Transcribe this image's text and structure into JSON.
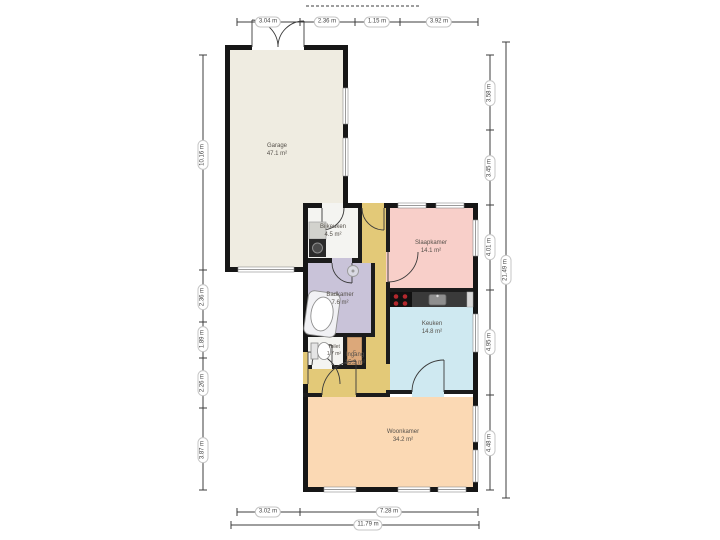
{
  "plan": {
    "rooms": [
      {
        "name": "Garage",
        "area": "47.1 m²"
      },
      {
        "name": "Bijkeuken",
        "area": "4.5 m²"
      },
      {
        "name": "Slaapkamer",
        "area": "14.1 m²"
      },
      {
        "name": "Badkamer",
        "area": "7.6 m²"
      },
      {
        "name": "Toilet",
        "area": "1.7 m²"
      },
      {
        "name": "Ingang",
        "area": "15.3 m²"
      },
      {
        "name": "Keuken",
        "area": "14.8 m²"
      },
      {
        "name": "Woonkamer",
        "area": "34.2 m²"
      }
    ],
    "closet_label": "c",
    "colors": {
      "garage": "#efece1",
      "utility": "#f4f4f1",
      "bedroom": "#f8cfc9",
      "bathroom": "#c9c3d9",
      "toilet": "#f4f4f1",
      "hall": "#e3c978",
      "kitchen": "#cfe9f1",
      "living": "#fbd9b4",
      "closet": "#dca87a",
      "wall": "#161616",
      "counter": "#3a3a3a",
      "burner": "#b3282d"
    },
    "dimensions": {
      "top": [
        "3.04 m",
        "2.36 m",
        "1.15 m",
        "3.92 m"
      ],
      "bottom": [
        "3.02 m",
        "7.28 m"
      ],
      "bottom_total": "11.79 m",
      "left": [
        "10.16 m",
        "2.36 m",
        "1.89 m",
        "2.26 m",
        "3.87 m"
      ],
      "right": [
        "3.58 m",
        "3.45 m",
        "4.01 m",
        "4.95 m",
        "4.48 m"
      ],
      "right_total": "21.49 m"
    }
  }
}
